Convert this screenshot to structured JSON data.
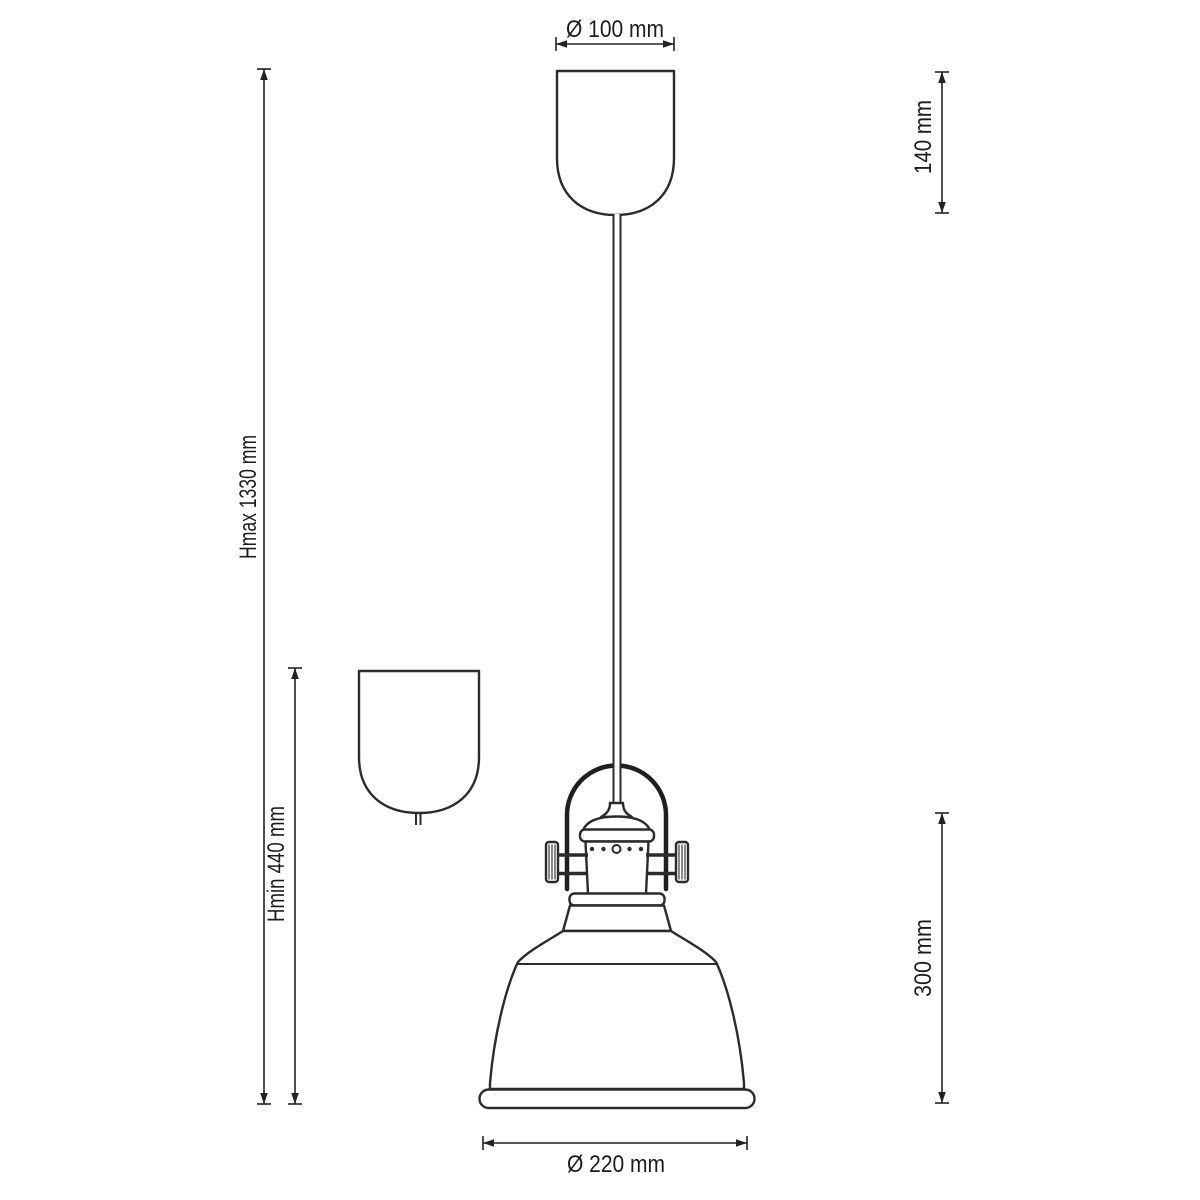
{
  "drawing": {
    "subject": "pendant-lamp-technical-drawing",
    "background_color": "#ffffff",
    "line_color": "#2b2b2b",
    "text_color": "#1c1c1c",
    "views": {
      "main_view": "pendant lamp with ceiling canopy, suspension cord, yoke-mounted socket and bell shade",
      "detail_view": "ceiling canopy at minimum height"
    },
    "dimensions": {
      "canopy_diameter": "Ø 100 mm",
      "canopy_height": "140 mm",
      "max_suspension_height": "Hmax 1330 mm",
      "min_suspension_height": "Hmin 440 mm",
      "shade_assembly_height": "300 mm",
      "shade_diameter": "Ø 220 mm"
    }
  }
}
